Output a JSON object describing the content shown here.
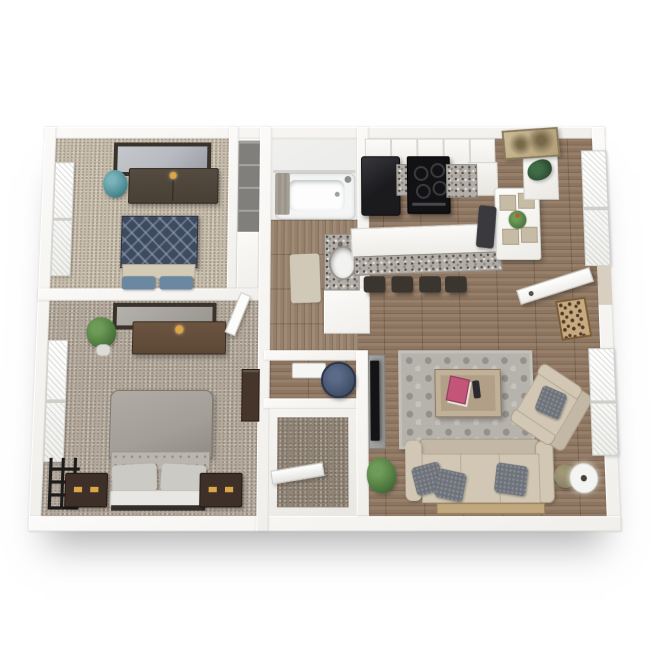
{
  "scene": {
    "type": "3d-rendered-apartment-floor-plan",
    "view": "top-down dollhouse render on white background",
    "visible_text": "none"
  },
  "palette": {
    "wall": "#f1efeb",
    "wallLight": "#fbfaf8",
    "wood": "#8d7560",
    "hallWood": "#96806a",
    "carpetBed1": "#c7bdac",
    "carpetBed2": "#b3a99c",
    "carpetCloset": "#8e8375",
    "bathFloor": "#e9eae8",
    "granite": "#b3afa8",
    "graniteDot": "#524e48",
    "appliance": "#1b1b1e",
    "stoveBlack": "#121214",
    "stool": "#3a352f",
    "toiletNavy": "#415069",
    "tubWhite": "#f4f6f6",
    "curtainGray": "#9a948b",
    "bathMat": "#d0c9b8",
    "duvetNavy": "#3e4b5e",
    "duvetDiamond": "#93a3b5",
    "footBand": "#d3cbb5",
    "pillowBlue": "#6c87a0",
    "dresserDark": "#483f35",
    "dresserBrown": "#5d4836",
    "gold": "#dca648",
    "mirrorGlass": "#b7bac0",
    "frameDark": "#3a332b",
    "plantGreen": "#4e7a3f",
    "plantTeal": "#4f8e96",
    "bedGray": "#a39f98",
    "tuftGray": "#bab6af",
    "pillowGray": "#cccac4",
    "headboard": "#e9e7e3",
    "nightstand": "#3e3028",
    "shelfBrown": "#46352a",
    "artBlack": "#1c1c1c",
    "sofa": "#d1c7b4",
    "sofaShade": "#c2b8a5",
    "pillowCharcoal": "#6e727a",
    "rug": "#b6b3ad",
    "rugDot": "#94918b",
    "coffeeTable": "#b19f88",
    "books": "#c25578",
    "remote": "#2b2b2f",
    "tv": "#141417",
    "console": "#959593",
    "lampBody": "#8a8266",
    "lampShade": "#f4f4f2",
    "doormatBase": "#c5ab84",
    "doormatSpot": "#54391f",
    "artSepia": "#b3a079",
    "artSepiaDark": "#77684a",
    "doorWhite": "#fcfcfa",
    "woodStrip": "#c2a87e"
  },
  "rooms": [
    {
      "name": "bedroom-1",
      "position": "top-left",
      "floor": "beige carpet",
      "furniture": [
        "dresser-with-mirror",
        "blue-diamond-pattern-bed",
        "teal-plant",
        "wall-window",
        "closet-nook"
      ]
    },
    {
      "name": "bedroom-2",
      "position": "bottom-left",
      "floor": "gray-brown carpet",
      "furniture": [
        "dresser-with-mirror",
        "gray-upholstered-bed",
        "two-nightstands",
        "potted-plant",
        "wall-window",
        "black-geometric-wall-art",
        "wall-shelf",
        "open-door"
      ]
    },
    {
      "name": "bathroom",
      "position": "top-middle",
      "floor": "wood",
      "furniture": [
        "bathtub-with-curtain",
        "granite-vanity-with-sink",
        "bath-mat"
      ]
    },
    {
      "name": "toilet-room",
      "position": "middle",
      "floor": "wood",
      "furniture": [
        "navy-toilet"
      ]
    },
    {
      "name": "closet",
      "position": "bottom-middle",
      "floor": "carpet",
      "furniture": [
        "shelf-rod"
      ]
    },
    {
      "name": "kitchen-dining",
      "position": "top-right",
      "floor": "wood",
      "furniture": [
        "upper-cabinets",
        "refrigerator",
        "range-stove",
        "granite-counters",
        "island-with-granite-bar",
        "four-bar-stools",
        "white-dining-table-with-four-chairs",
        "centerpiece-plant",
        "side-cabinet",
        "sepia-wall-art",
        "window"
      ]
    },
    {
      "name": "entry",
      "position": "right",
      "furniture": [
        "open-front-door",
        "leopard-doormat"
      ]
    },
    {
      "name": "living-room",
      "position": "bottom-right",
      "floor": "wood",
      "furniture": [
        "wall-tv-with-console",
        "hex-pattern-area-rug",
        "coffee-table-with-books-and-remote",
        "beige-sofa-with-gray-pillows",
        "beige-armchair",
        "floor-lamp",
        "potted-plant",
        "console-strip",
        "window"
      ]
    }
  ]
}
